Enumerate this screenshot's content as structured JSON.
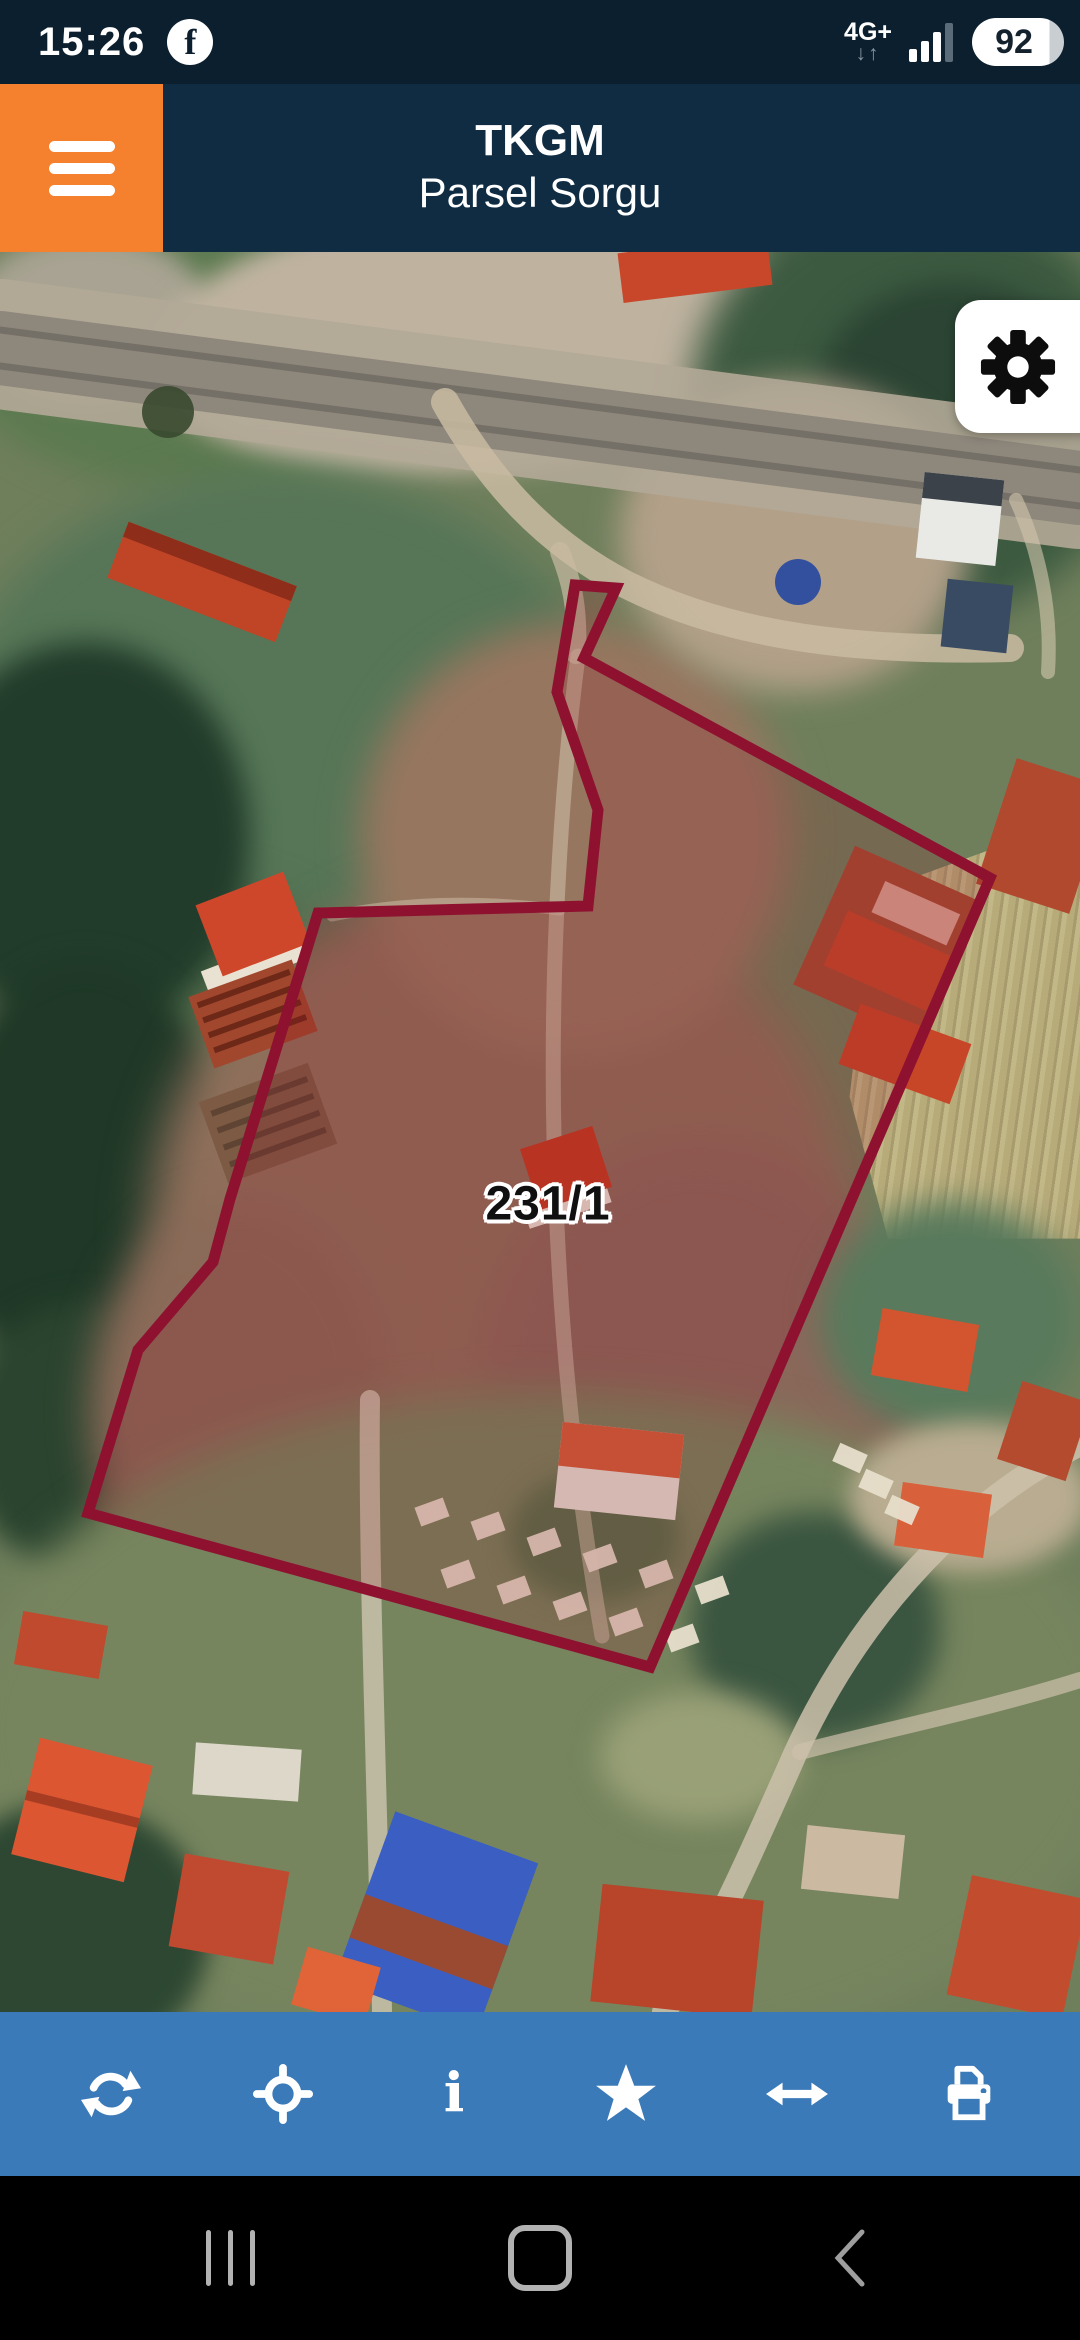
{
  "status_bar": {
    "time": "15:26",
    "facebook_icon_letter": "f",
    "network": "4G+",
    "down_arrow": "↓",
    "up_arrow": "↑",
    "battery": "92"
  },
  "header": {
    "title_line1": "TKGM",
    "title_line2": "Parsel Sorgu",
    "menu_icon": "hamburger-menu"
  },
  "map": {
    "type": "satellite-imagery",
    "parcel_label": "231/1",
    "settings_icon": "gear"
  },
  "toolbar": {
    "icons": [
      "refresh",
      "locate",
      "info",
      "favorite-star",
      "measure-horizontal",
      "print"
    ],
    "info_glyph": "i"
  },
  "nav_bar": {
    "icons": [
      "recents",
      "home",
      "back"
    ]
  },
  "colors": {
    "status_navy": "#0c1f2e",
    "header_navy": "#0f2c43",
    "accent_orange": "#f5812e",
    "toolbar_blue": "#3b7ab8",
    "parcel_outline": "#8e1230",
    "nav_black": "#000000"
  }
}
